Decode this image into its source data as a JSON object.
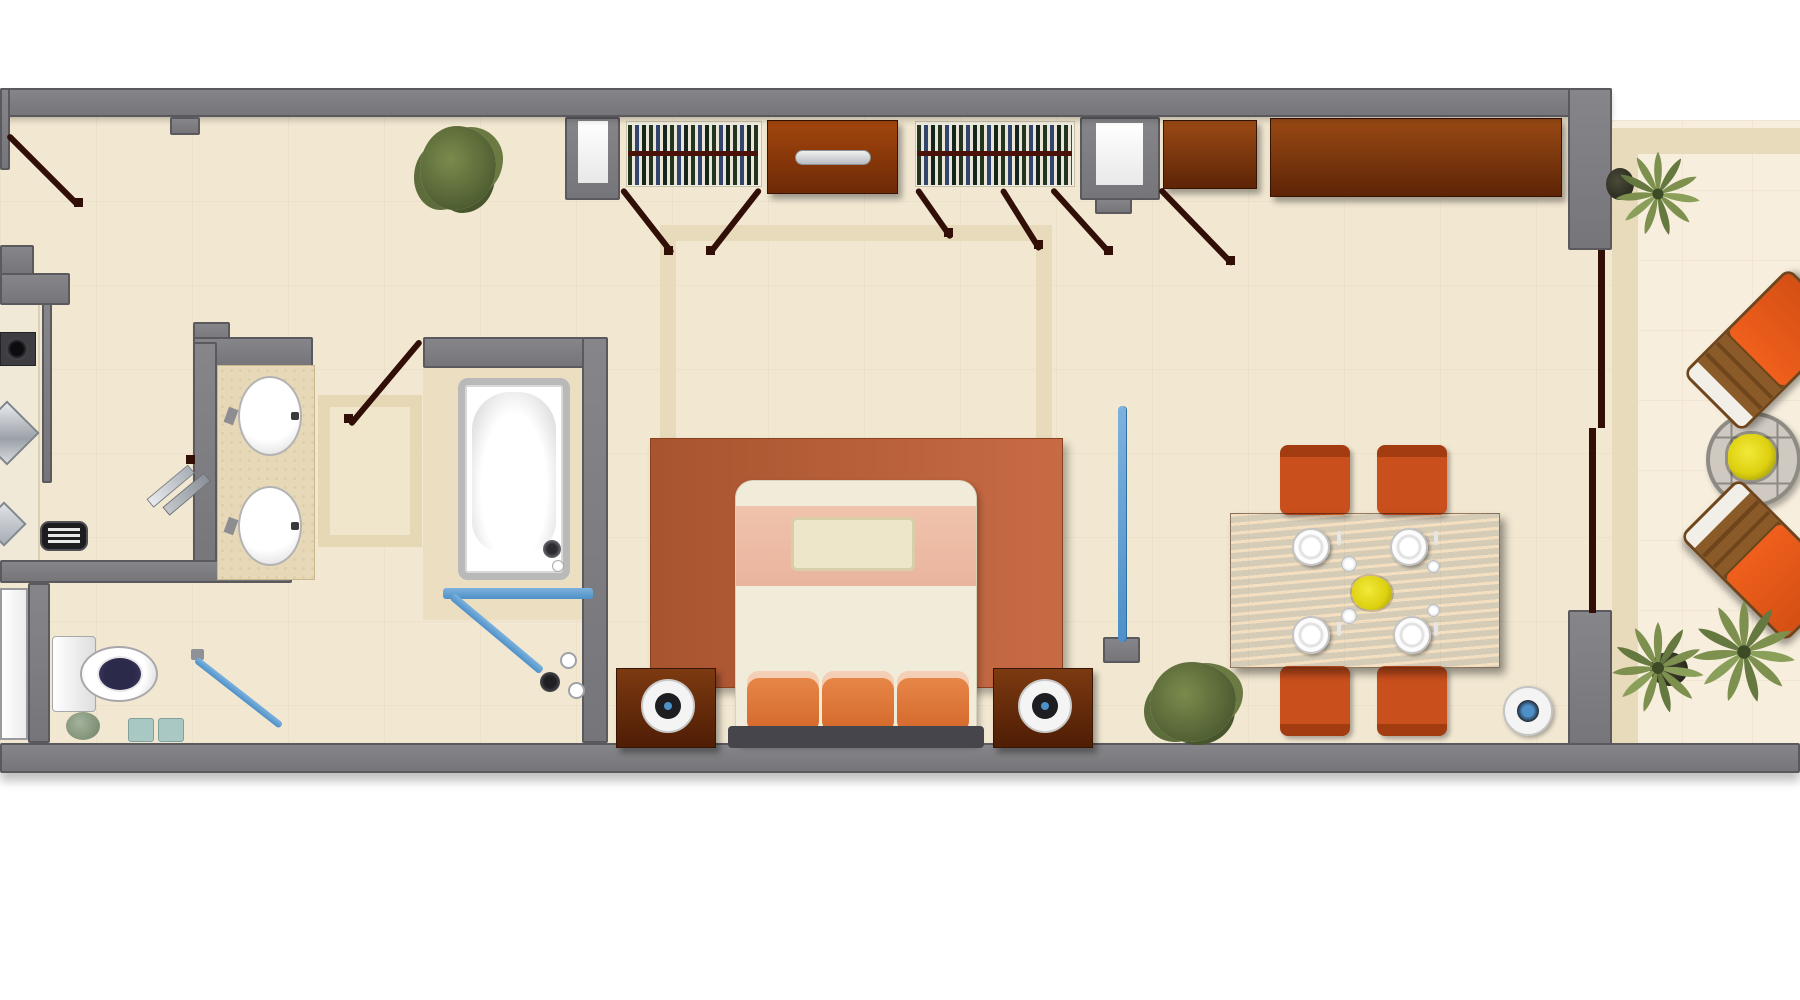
{
  "meta": {
    "type": "floor-plan",
    "description": "Top-down furnished floor plan of a long one-bedroom suite: entry with kitchenette, double-sink vanity, bathtub and shower, separate toilet room, hallway walk-in closet with dresser and wardrobe niches, bedroom with king bed, nightstand lamps and area rug, dining area with table for four, and a balcony terrace with palms, two sun loungers and a round table.",
    "visible_text": []
  },
  "colors": {
    "wall": "#76767a",
    "wall_edge": "#5a5a5e",
    "floor": "#f2e8d2",
    "balcony_floor": "#f7eedd",
    "tile_border": "#e8dbbb",
    "tub_tile": "#ecdfc1",
    "counter": "#e7d9b8",
    "wood_light": "#9a4a14",
    "wood_dark": "#5d2406",
    "table_wood": "#702c0a",
    "rug_left": "#a8542f",
    "rug_right": "#c76b45",
    "bed_cream": "#f1ecda",
    "bed_pink": "#eab49e",
    "bed_cushion": "#eee6c9",
    "pillow_orange": "#d4682b",
    "headboard": "#45454b",
    "chair_orange": "#c94f1d",
    "chair_cap": "#a33c10",
    "accent_blue": "#4e90c8",
    "door_leaf": "#310f06",
    "plant_green": "#6e7f44",
    "palm_green": "#7d904e",
    "flower_yellow": "#ddd00f",
    "lamp_ring": "#f4f4f4",
    "lamp_core": "#1d1d22",
    "toilet_seat": "#3c3a60",
    "metal": "#c9ccd1",
    "white": "#ffffff"
  },
  "rooms": [
    {
      "name": "entry-kitchenette"
    },
    {
      "name": "vanity-bathroom"
    },
    {
      "name": "bathtub-shower-room"
    },
    {
      "name": "toilet-room"
    },
    {
      "name": "closet-hallway"
    },
    {
      "name": "bedroom"
    },
    {
      "name": "dining-area"
    },
    {
      "name": "balcony-terrace"
    }
  ],
  "furniture": {
    "kitchen": [
      "cooktop",
      "sink",
      "prep-sink",
      "toaster",
      "counter"
    ],
    "bathroom": [
      "double-sink-vanity",
      "bathtub",
      "shower-screen",
      "shower-fixtures",
      "ironing-board"
    ],
    "toilet_room": [
      "toilet",
      "hamper",
      "slippers",
      "towel-rail",
      "door-panel"
    ],
    "closet": [
      "hanging-clothes-left",
      "hanging-clothes-right",
      "dresser",
      "wall-niche-left",
      "wall-niche-right",
      "wardrobe-credenza"
    ],
    "bedroom": [
      "king-bed",
      "orange-pillows",
      "headboard",
      "area-rug",
      "nightstand-left",
      "nightstand-right",
      "lamp-left",
      "lamp-right",
      "potted-shrub",
      "glass-partition"
    ],
    "dining": [
      "dining-table",
      "dining-chairs-x4",
      "place-settings-x4",
      "flower-centerpiece",
      "floor-bowl",
      "potted-shrub"
    ],
    "balcony": [
      "sliding-door-panels",
      "palm-top",
      "palm-bottom-left",
      "palm-bottom-right",
      "sun-lounger-top",
      "sun-lounger-bottom",
      "round-table-with-flowers"
    ]
  },
  "door_count": 8,
  "sink_count": 4,
  "chair_count": 4,
  "plate_count": 4
}
